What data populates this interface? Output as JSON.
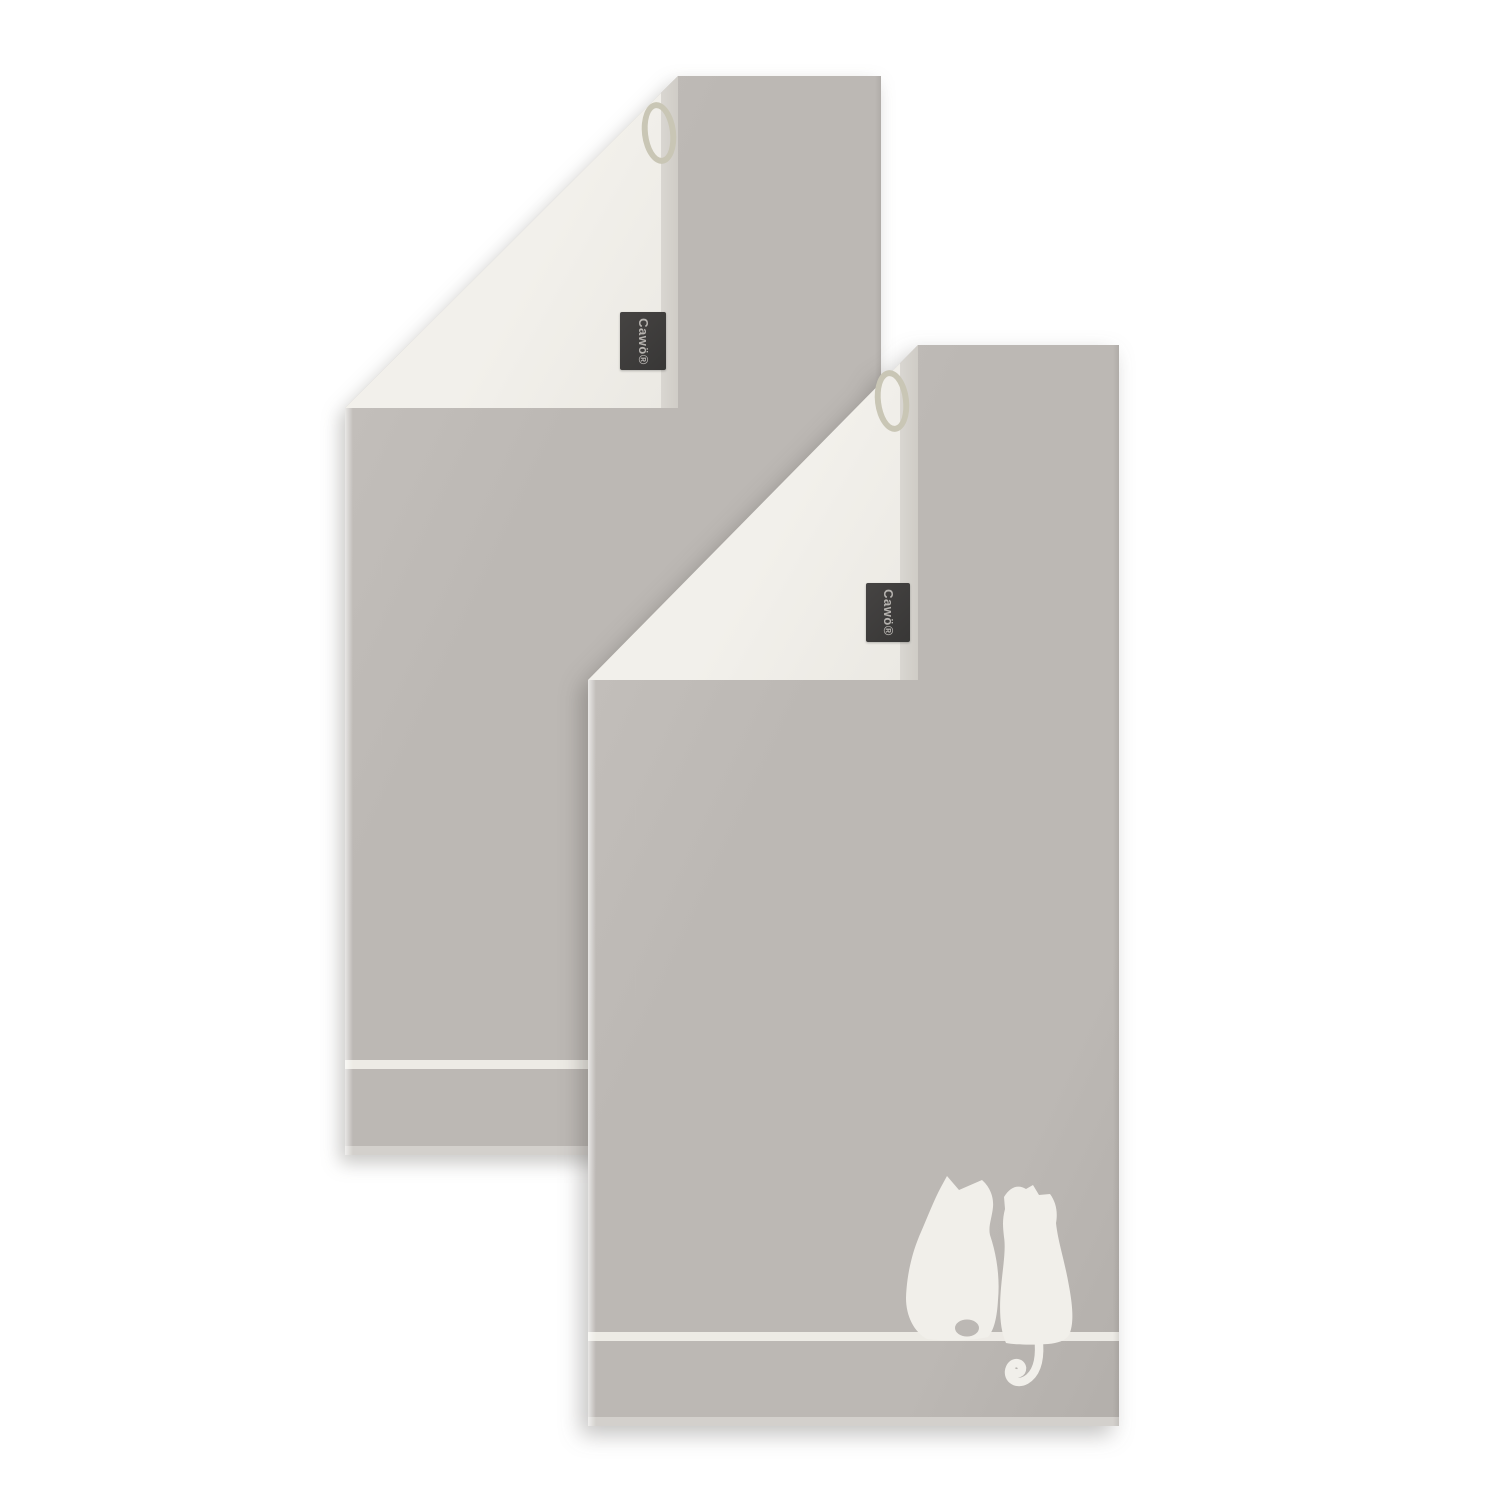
{
  "meta": {
    "type": "product-photo",
    "subject": "Two reversible grey terry towels, each with top corner folded over showing white reverse, hanging loop and woven brand label; front towel has white silhouette motif of two cats sitting on a line above the bottom hem"
  },
  "brand": {
    "name": "Cawö"
  },
  "towels": {
    "back": {
      "label_text": "Cawö®"
    },
    "front": {
      "label_text": "Cawö®"
    }
  },
  "motif": {
    "name": "two-cats-silhouette",
    "cat_count": 2
  },
  "colors": {
    "page-bg": "#ffffff",
    "towel-gray": "#bcb8b4",
    "towel-gray-light": "#c6c2be",
    "towel-gray-deep": "#b3afab",
    "reverse-white": "#f2f0eb",
    "reverse-white-deep": "#eae8e2",
    "selvage": "#d9d6d1",
    "selvage-deep": "#cfccc6",
    "stripe-white": "#efede8",
    "hem-light": "#d3d0cc",
    "label-bg": "#454342",
    "label-bg-deep": "#383736",
    "label-text": "#b6b3af",
    "loop-cord": "#c9c6b5",
    "cat-white": "#f1efea"
  }
}
